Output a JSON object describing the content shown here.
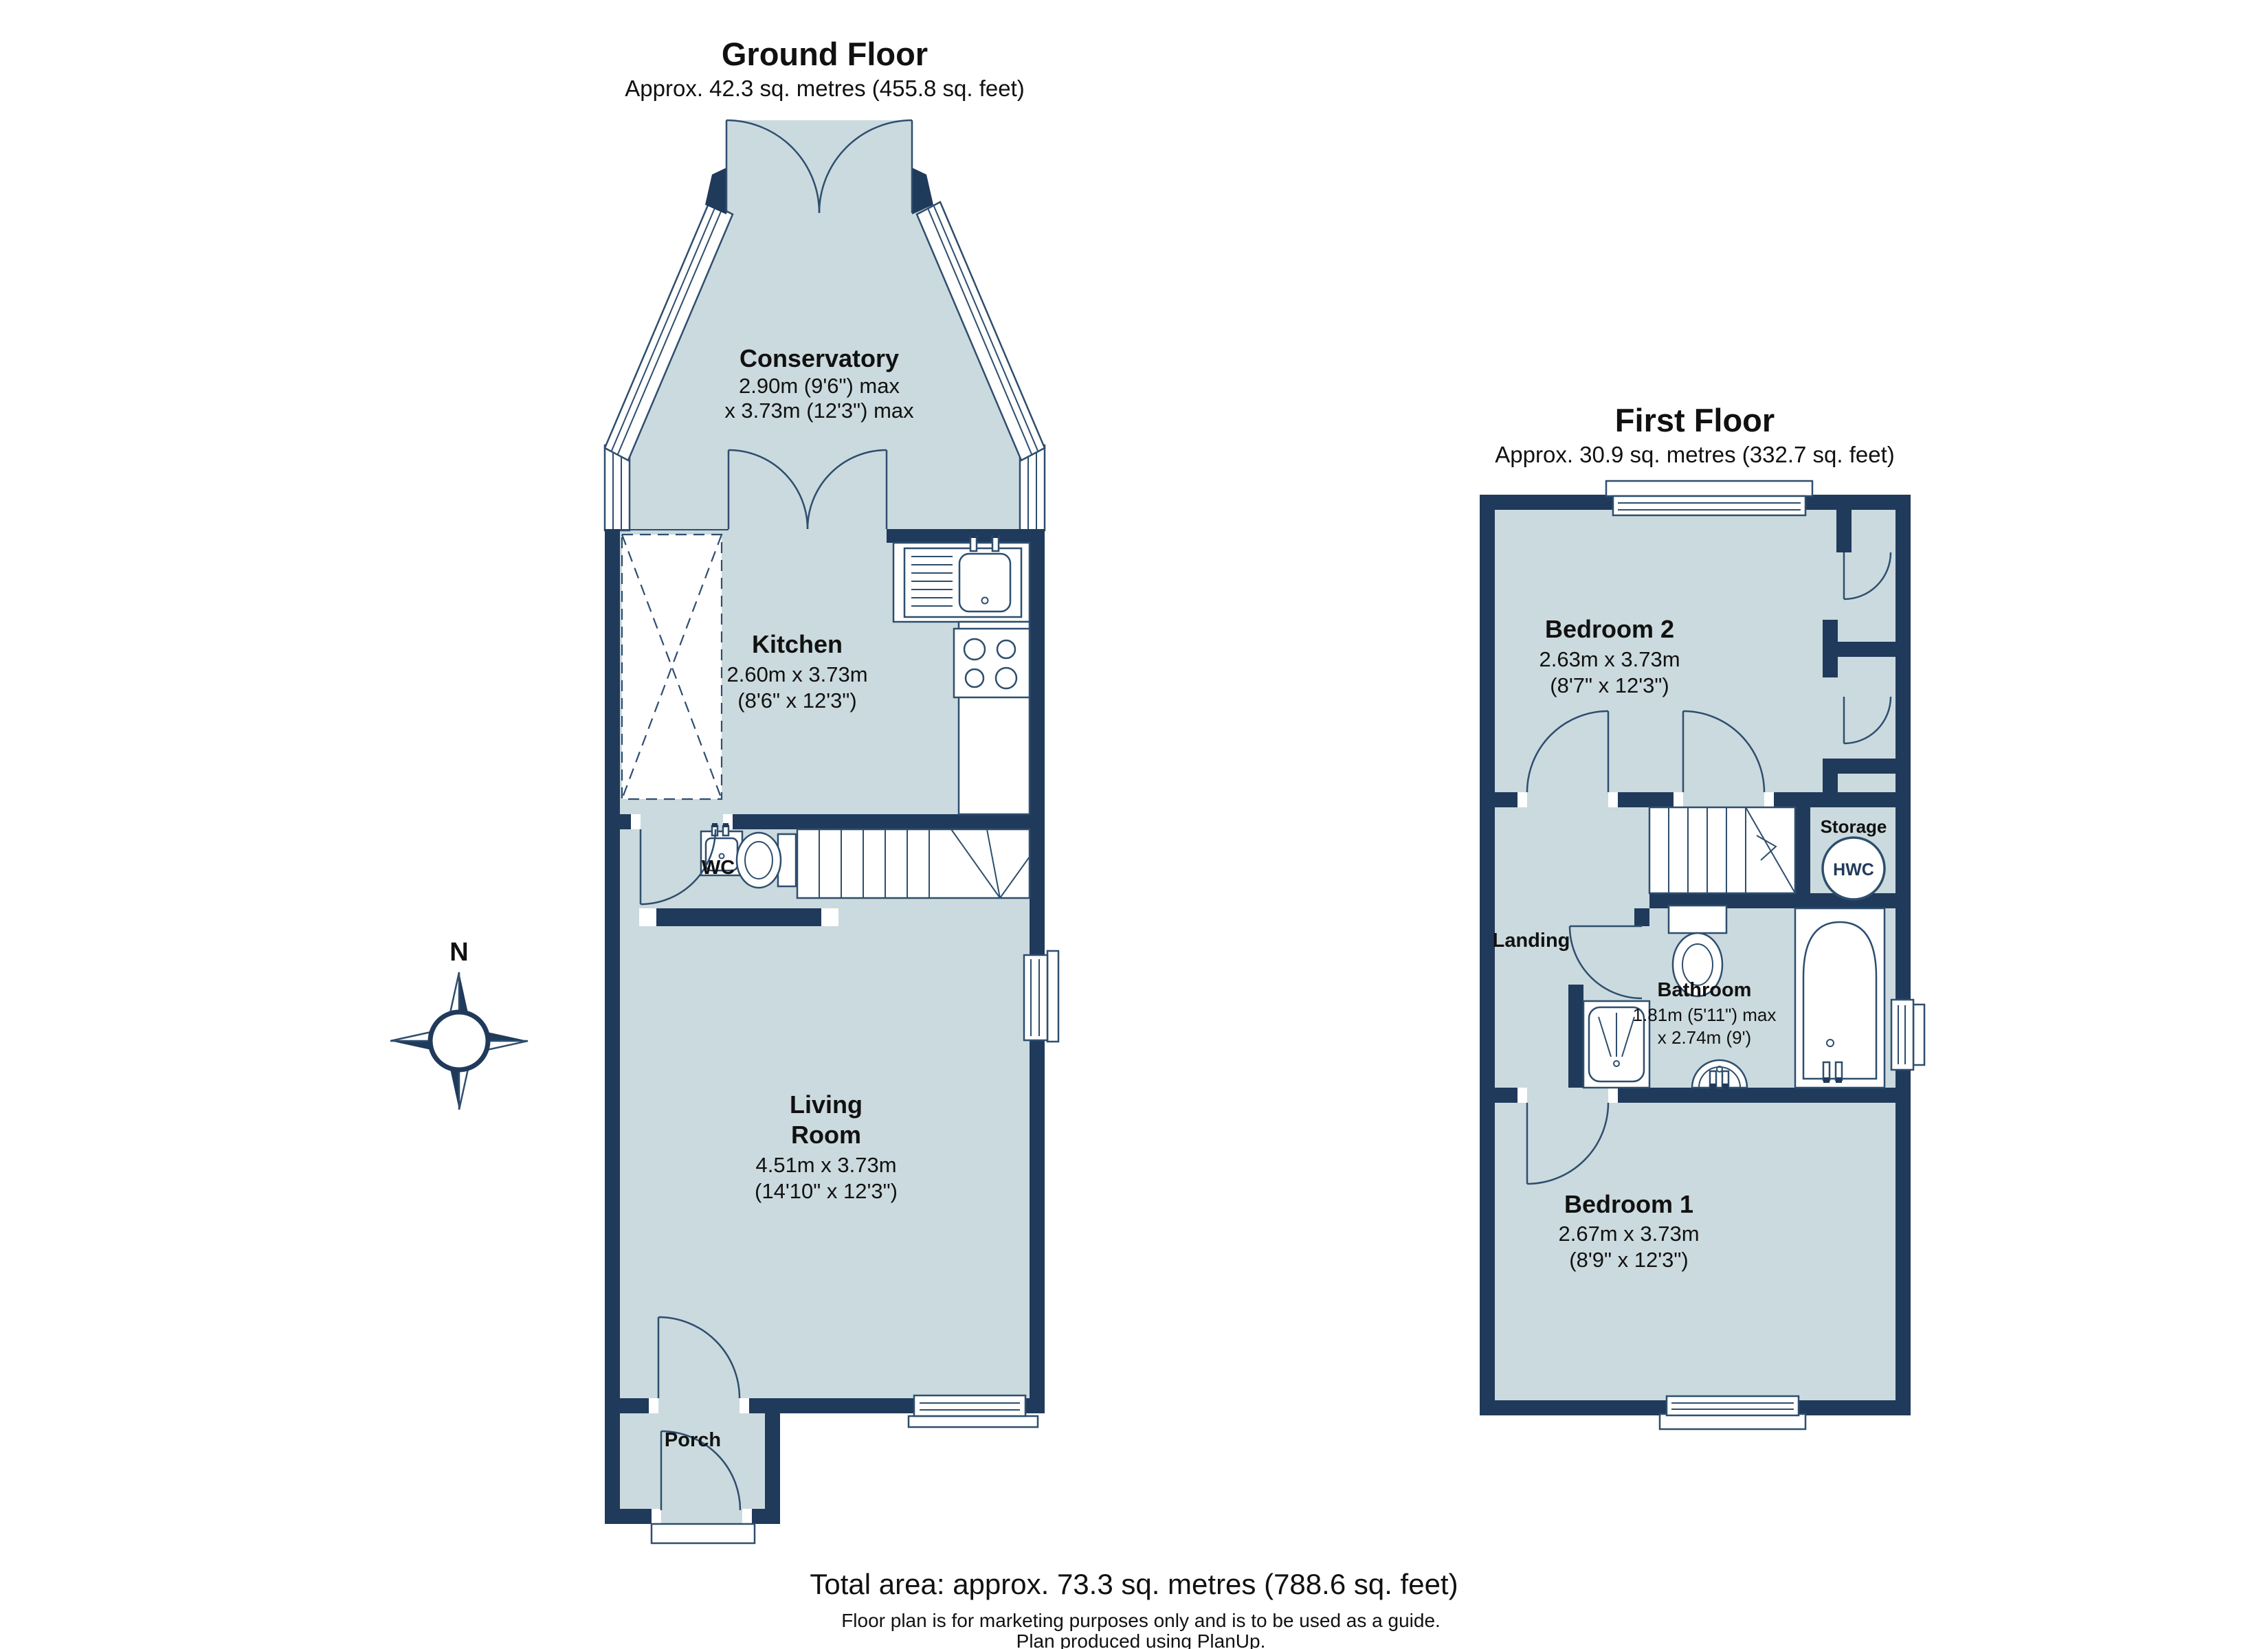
{
  "ground": {
    "title": "Ground Floor",
    "subtitle": "Approx. 42.3 sq. metres (455.8 sq. feet)",
    "rooms": {
      "conservatory": {
        "name": "Conservatory",
        "dim1": "2.90m (9'6\") max",
        "dim2": "x 3.73m (12'3\") max"
      },
      "kitchen": {
        "name": "Kitchen",
        "dim1": "2.60m x 3.73m",
        "dim2": "(8'6\" x 12'3\")"
      },
      "wc": {
        "name": "WC"
      },
      "living": {
        "name1": "Living",
        "name2": "Room",
        "dim1": "4.51m x 3.73m",
        "dim2": "(14'10\" x 12'3\")"
      },
      "porch": {
        "name": "Porch"
      }
    }
  },
  "first": {
    "title": "First Floor",
    "subtitle": "Approx. 30.9 sq. metres (332.7 sq. feet)",
    "rooms": {
      "bedroom2": {
        "name": "Bedroom 2",
        "dim1": "2.63m x 3.73m",
        "dim2": "(8'7\" x 12'3\")"
      },
      "storage": {
        "name": "Storage",
        "tank_label": "HWC"
      },
      "landing": {
        "name": "Landing"
      },
      "bathroom": {
        "name": "Bathroom",
        "dim1": "1.81m (5'11\") max",
        "dim2": "x 2.74m (9')"
      },
      "bedroom1": {
        "name": "Bedroom 1",
        "dim1": "2.67m x 3.73m",
        "dim2": "(8'9\" x 12'3\")"
      }
    }
  },
  "compass": {
    "north_label": "N"
  },
  "footer": {
    "total_area": "Total area: approx. 73.3 sq. metres (788.6 sq. feet)",
    "disclaimer": "Floor plan is for marketing purposes only and is to be used as a guide.",
    "produced": "Plan produced using PlanUp."
  },
  "colors": {
    "wall": "#203A5B",
    "room": "#CBDADE",
    "line": "#2E4E6E",
    "text": "#111111"
  }
}
